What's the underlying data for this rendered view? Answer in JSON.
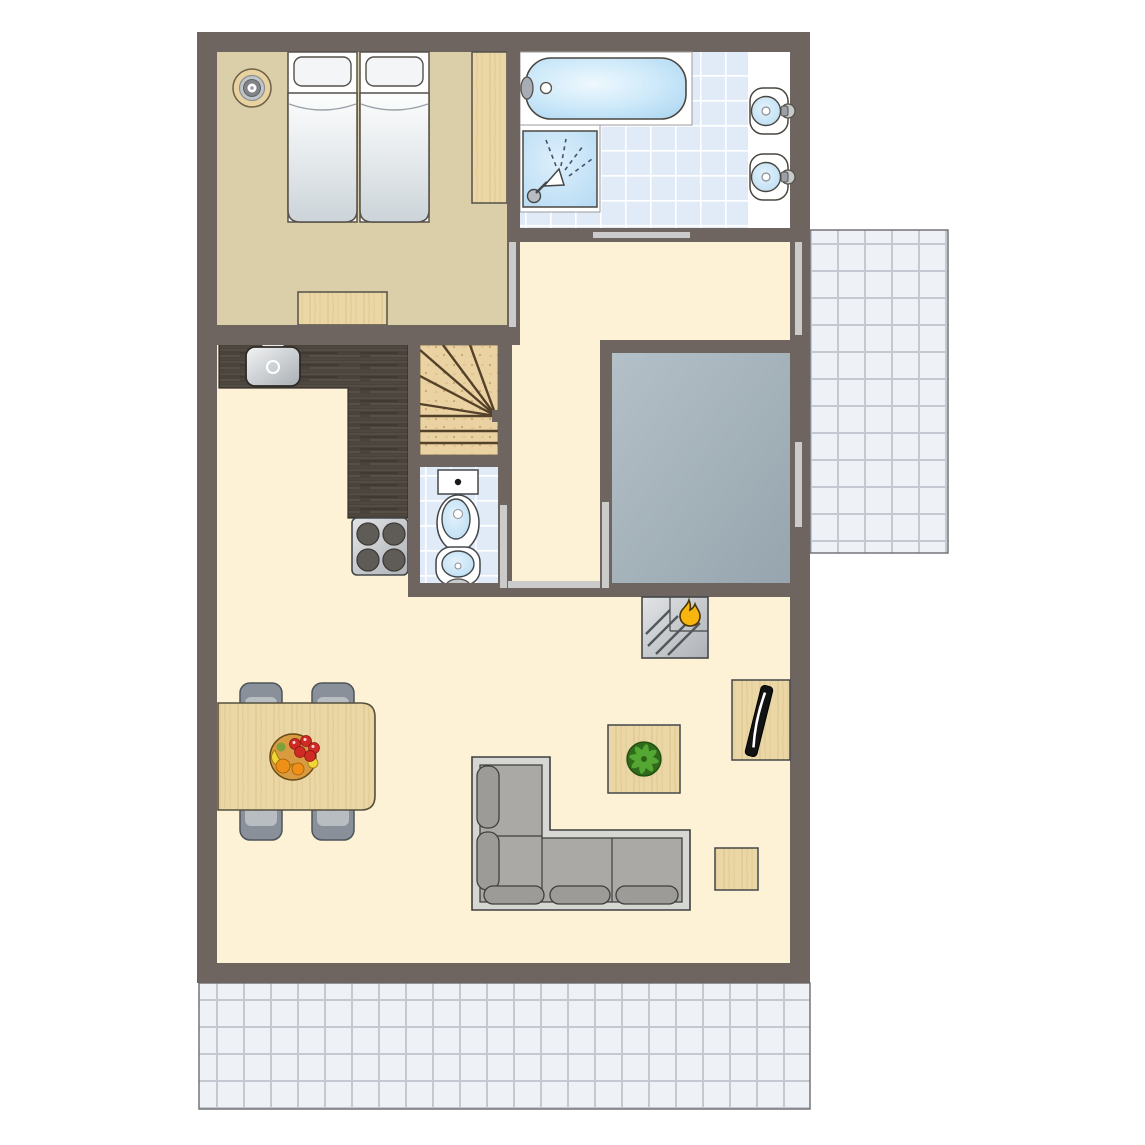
{
  "title": "Holiday home floor plan (top-down architectural drawing, no text labels)",
  "colors": {
    "wall": "#6f6560",
    "outline": "#4b4740",
    "floor_cream": "#fdf2d6",
    "floor_beige": "#dbcfaa",
    "wood": "#ead7a5",
    "wood_line": "#d5bc82",
    "stairs_wood": "#ebd2a2",
    "stairs_line": "#54412a",
    "counter": "#4a433c",
    "tile_blue": "#e1eaf7",
    "tile_grid": "#ffffff",
    "terrace_tile": "#eef1f5",
    "terrace_grid": "#c4c9d1",
    "gray_room": "#a4b2bb",
    "door": "#cbcbcb",
    "white": "#ffffff",
    "fixture_blue": "#b7dcf4",
    "sofa_frame": "#d6d7d3",
    "sofa_seat": "#aba9a5",
    "sofa_pill": "#9d9b97",
    "chair": "#8a9099",
    "chair_inner": "#b8bdc2",
    "stove": "#c9ccce",
    "burner": "#5f5b57",
    "flame": "#f7b510",
    "plant": "#58ab36",
    "plant_dark": "#2f6b1a",
    "fruit_red": "#d02a24",
    "fruit_orange": "#ef9016",
    "fruit_yellow": "#f2d435",
    "bowl": "#d89b3f",
    "tv": "#121212"
  },
  "legend": {
    "rooms": [
      {
        "name": "bedroom",
        "floor": "beige",
        "items": [
          "twin-bed-left",
          "twin-bed-right",
          "wardrobe",
          "dresser",
          "bedside-lamp"
        ]
      },
      {
        "name": "bathroom",
        "floor": "blue-tiles",
        "items": [
          "bathtub",
          "shower",
          "washbasin-top",
          "washbasin-bottom"
        ]
      },
      {
        "name": "hallway",
        "floor": "cream",
        "items": [
          "winder-staircase"
        ]
      },
      {
        "name": "wc",
        "floor": "blue-tiles",
        "items": [
          "toilet",
          "hand-basin"
        ]
      },
      {
        "name": "storage-room",
        "floor": "gray",
        "items": []
      },
      {
        "name": "kitchen",
        "floor": "cream",
        "items": [
          "l-shaped-counter",
          "kitchen-sink",
          "stove-4-burners"
        ]
      },
      {
        "name": "living-dining-room",
        "floor": "cream",
        "items": [
          "fireplace",
          "tv-cabinet",
          "plant-table",
          "corner-sofa",
          "dining-table",
          "four-chairs",
          "fruit-bowl",
          "side-table"
        ]
      },
      {
        "name": "terrace-right",
        "floor": "white-tiles",
        "items": []
      },
      {
        "name": "terrace-bottom",
        "floor": "white-tiles",
        "items": []
      }
    ],
    "openings": [
      {
        "name": "bathroom-door"
      },
      {
        "name": "bedroom-door"
      },
      {
        "name": "hall-terrace-door"
      },
      {
        "name": "storage-room-door"
      },
      {
        "name": "storage-room-window"
      },
      {
        "name": "wc-door"
      },
      {
        "name": "living-room-passage"
      }
    ]
  }
}
